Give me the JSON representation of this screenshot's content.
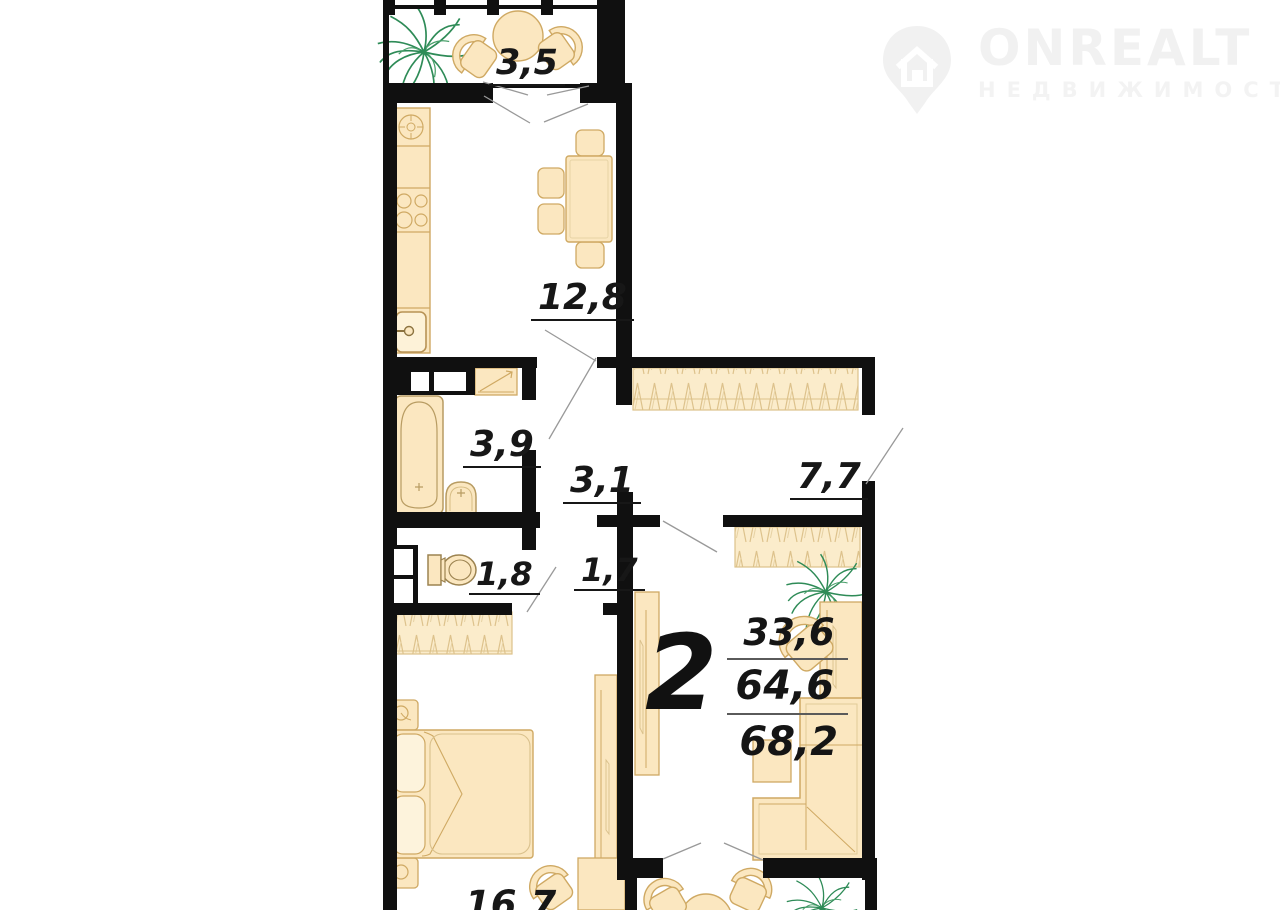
{
  "watermark": {
    "brand": "ONREALT",
    "tagline": "НЕДВИЖИМОСТЬ"
  },
  "rooms": {
    "balcony": "3,5",
    "kitchen": "12,8",
    "bathroom": "3,9",
    "hall": "3,1",
    "corridor": "7,7",
    "wc": "1,8",
    "hall2": "1,7",
    "bedroom": "16,7"
  },
  "summary": {
    "rooms_count": "2",
    "living_area": "33,6",
    "usable_area": "64,6",
    "total_area": "68,2"
  },
  "colors": {
    "wall": "#101010",
    "furniture_fill": "#fbe7c0",
    "furniture_stroke": "#cfa963",
    "plant": "#2e8b57",
    "leader_line": "#999999"
  }
}
